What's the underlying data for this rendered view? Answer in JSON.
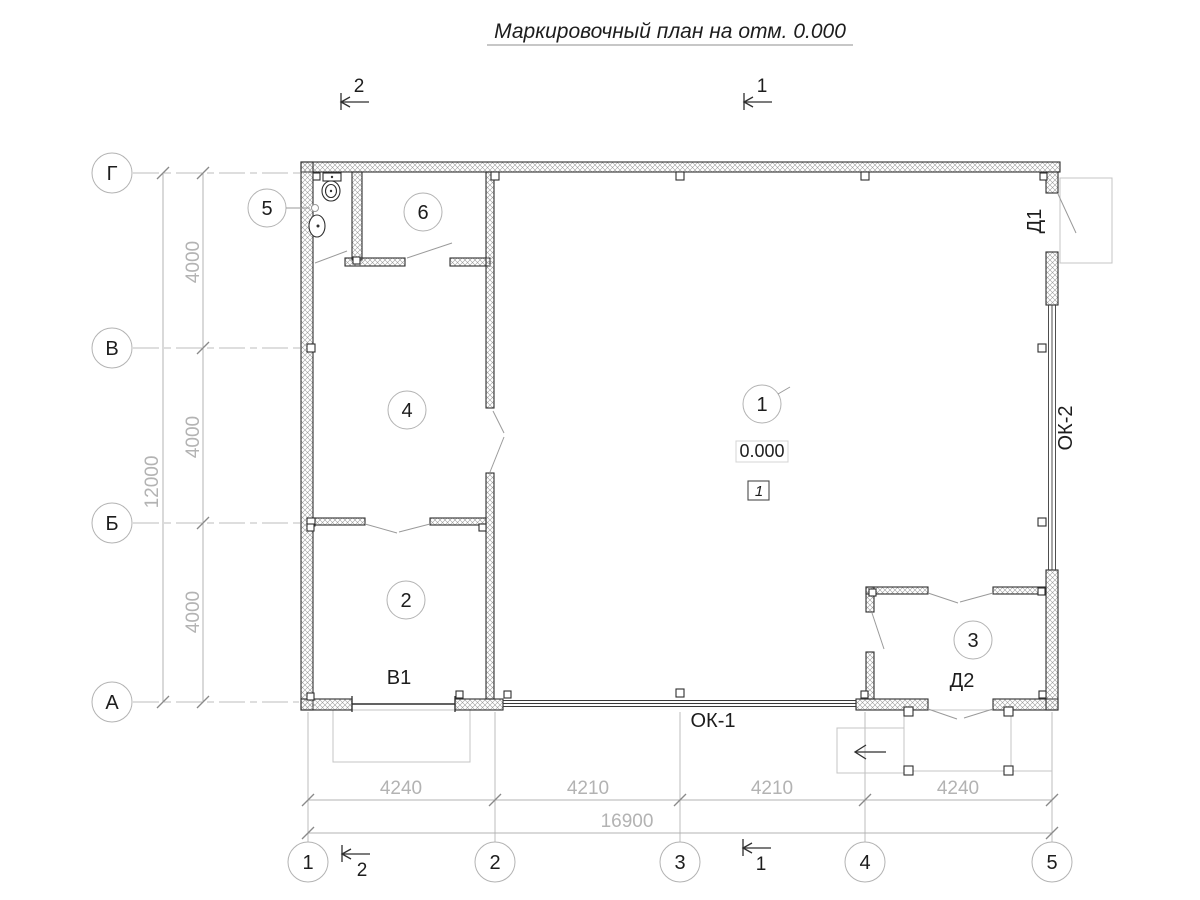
{
  "title": {
    "text": "Маркировочный план на отм. 0.000"
  },
  "sections": {
    "top": [
      "2",
      "1"
    ],
    "bottom": [
      "2",
      "1"
    ]
  },
  "grid": {
    "row_labels": [
      "Г",
      "В",
      "Б",
      "А"
    ],
    "col_labels": [
      "1",
      "2",
      "3",
      "4",
      "5"
    ]
  },
  "dimensions": {
    "left_segments": [
      "4000",
      "4000",
      "4000"
    ],
    "left_total": "12000",
    "bottom_segments": [
      "4240",
      "4210",
      "4210",
      "4240"
    ],
    "bottom_total": "16900"
  },
  "rooms": [
    "1",
    "2",
    "3",
    "4",
    "5",
    "6"
  ],
  "marks": {
    "door1": "Д1",
    "door2": "Д2",
    "gate": "В1",
    "window1": "ОК-1",
    "window2": "ОК-2"
  },
  "elevation": {
    "value": "0.000",
    "floor_type": "1"
  },
  "colors": {
    "line_dark": "#2f2f2f",
    "line_light": "#b3b3b3",
    "text_dark": "#1d1d1d",
    "background": "#ffffff"
  }
}
